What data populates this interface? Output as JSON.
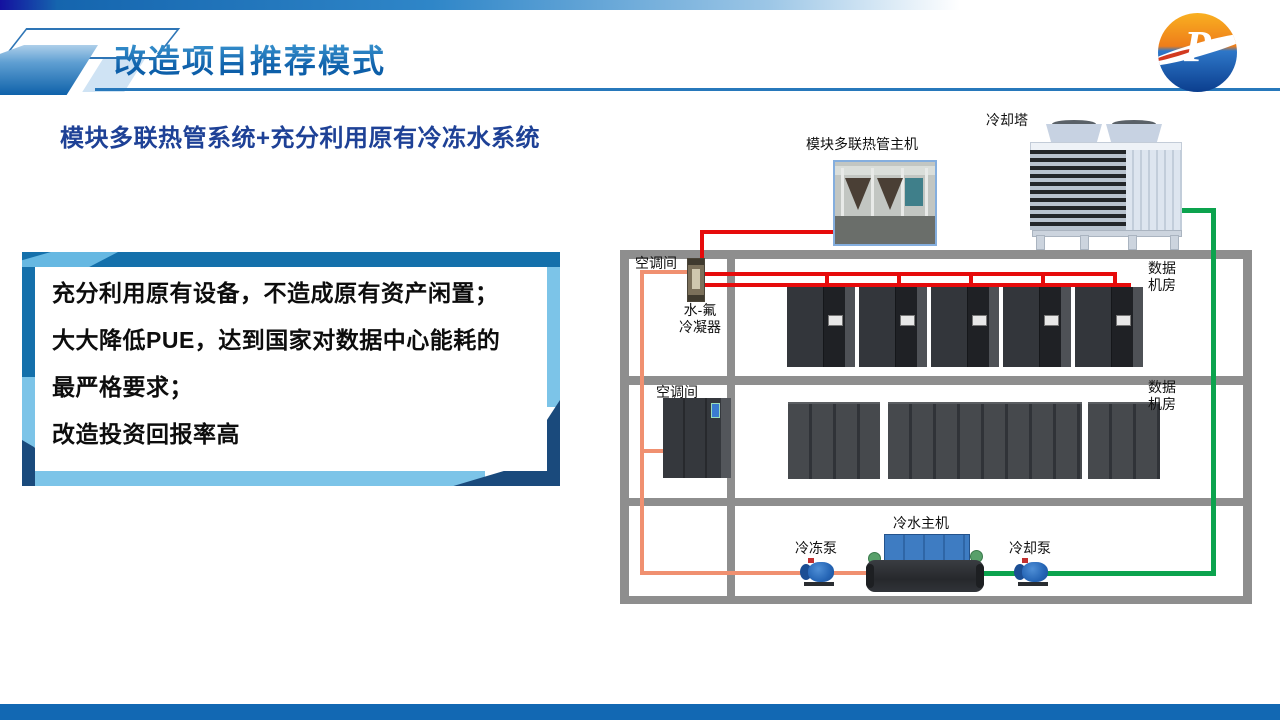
{
  "header": {
    "title": "改造项目推荐模式",
    "logo_letter": "P"
  },
  "subtitle": "模块多联热管系统+充分利用原有冷冻水系统",
  "info_box": {
    "lines": [
      "充分利用原有设备，不造成原有资产闲置；",
      "大大降低PUE，达到国家对数据中心能耗的",
      "最严格要求；",
      "改造投资回报率高"
    ]
  },
  "diagram": {
    "labels": {
      "cooling_tower": "冷却塔",
      "heat_pipe_main_unit": "模块多联热管主机",
      "ac_room": "空调间",
      "water_fluorine_condenser": [
        "水-氟",
        "冷凝器"
      ],
      "data_room": [
        "数据",
        "机房"
      ],
      "chiller": "冷水主机",
      "chilled_water_pump": "冷冻泵",
      "cooling_water_pump": "冷却泵"
    },
    "pipe_colors": {
      "refrigerant": "#e60b0b",
      "chilled_water": "#f09070",
      "cooling_water": "#0ca34e",
      "room_frame": "#8e8e8e"
    }
  },
  "footer": {
    "bar_color": "#1268b3"
  }
}
